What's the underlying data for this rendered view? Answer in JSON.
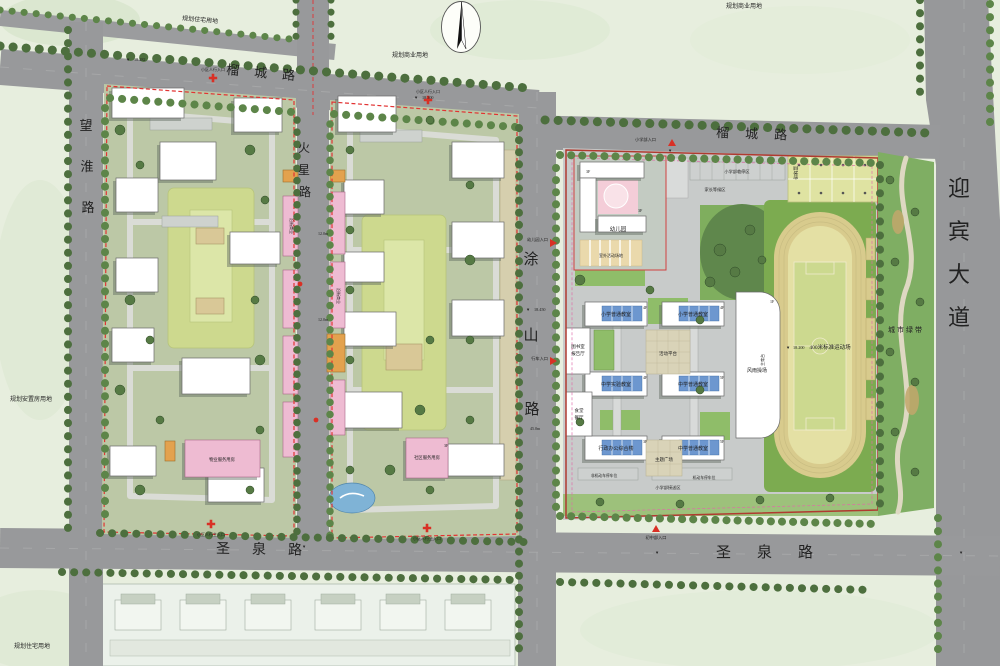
{
  "roads": {
    "liucheng": "榴城路",
    "shengquan": "圣泉路",
    "wanghuai": {
      "chars": [
        "望",
        "淮",
        "路"
      ]
    },
    "huoxing": {
      "chars": [
        "火",
        "星",
        "路"
      ]
    },
    "tushan": {
      "chars": [
        "涂",
        "山",
        "路"
      ]
    },
    "yingbin": {
      "chars": [
        "迎",
        "宾",
        "大",
        "道"
      ]
    }
  },
  "parcels": {
    "top_left": "规划住宅用地",
    "top_mid": "规划商业用地",
    "top_right": "规划商业用地",
    "west": "规划安置房用地",
    "bottom_left": "规划住宅用地"
  },
  "residential": {
    "commercial": "沿街商业",
    "community_east": "社区服务用房",
    "community_west": "物业服务用房",
    "entr_main": "小区人行主入口",
    "entr_side": "小区人行入口"
  },
  "school": {
    "kindergarten": "幼儿园",
    "outdoor": "室外活动场地",
    "primary_classroom": "小学普通教室",
    "middle_classroom": "中学普通教室",
    "middle_lab": "中学实验教室",
    "admin": "行政办公综合楼",
    "library1": "图书室",
    "library2": "报告厅",
    "canteen1": "食堂",
    "canteen2": "餐厅",
    "gym": "风雨操场",
    "plaza": "活动平台",
    "theme_plaza": "主题广场",
    "track": "400米标准运动场",
    "rostrum": "主席台",
    "basketball": "篮球场",
    "greenbelt": "城市绿带",
    "parking_temp": "小学部临停区",
    "waiting": "家长等候区",
    "dropoff": "小学部接送区",
    "bike_parking": "非机动车停车位",
    "car_parking": "机动车停车位",
    "entr_primary": "小学部入口",
    "entr_junior": "初中部入口",
    "entr_kg": "幼儿园入口",
    "entr_vehicle": "行车入口",
    "f1": "1F",
    "f2": "2F",
    "f3": "3F",
    "f4": "4F",
    "f5": "5F"
  },
  "dims": {
    "d12": "12.0m",
    "d45": "45.0m"
  },
  "elevations": {
    "e1": "18.282",
    "e2": "18.300",
    "e3": "18.450",
    "e4": "18.200"
  },
  "markers": {
    "down": "▼"
  },
  "colors": {
    "road": "#98999b",
    "parcel": "#e7eede",
    "site": "#bcc8a6",
    "school_paving": "#c8cbca",
    "building": "#ffffff",
    "commercial_pink": "#eebbd2",
    "orange": "#e3a24e",
    "solar_blue": "#6d97cf",
    "track_ring": "#d8cb8d",
    "track_field": "#e4e0a4",
    "lawn": "#7cab50",
    "greenbelt": "#7fae63",
    "tree": "#557a44",
    "boundary_red": "#e23333",
    "courtyard": "#cdd98e"
  }
}
